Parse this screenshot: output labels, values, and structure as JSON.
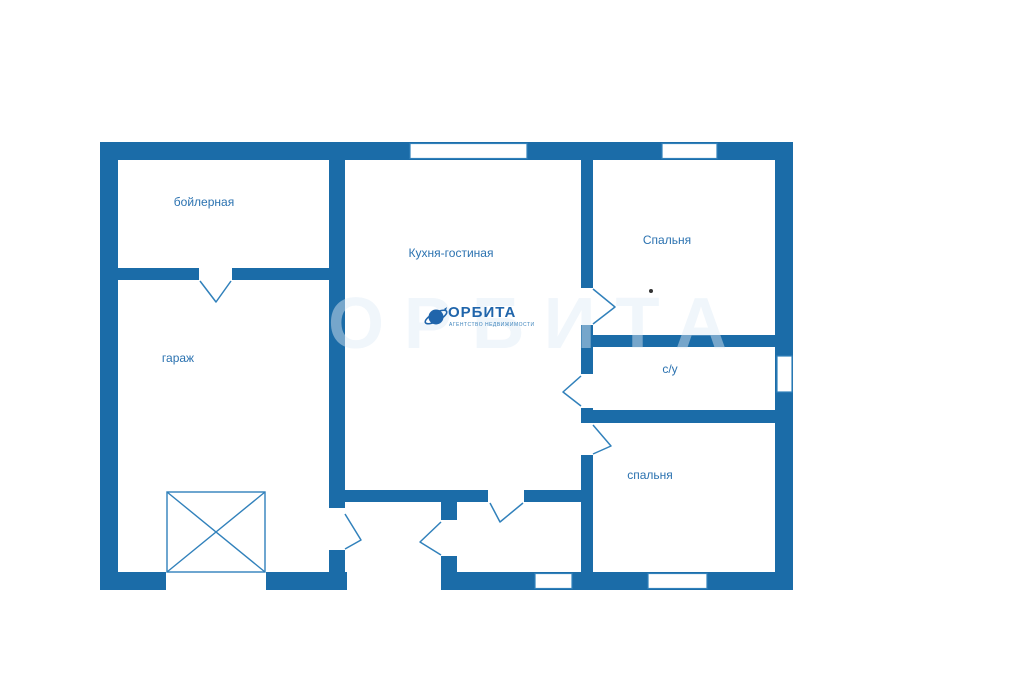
{
  "plan_title": "house floor plan",
  "rooms": {
    "boiler_room": "бойлерная",
    "garage": "гараж",
    "kitchen_living": "Кухня-гостиная",
    "bedroom_top": "Спальня",
    "bathroom": "с/у",
    "bedroom_bottom": "спальня"
  },
  "logo": {
    "name": "ОРБИТА",
    "tagline": "АГЕНТСТВО НЕДВИЖИМОСТИ"
  },
  "watermark": "ОРБИТА",
  "colors": {
    "wall": "#1b6ca8",
    "line": "#3181bb",
    "label": "#2b72b0",
    "background": "#ffffff"
  }
}
